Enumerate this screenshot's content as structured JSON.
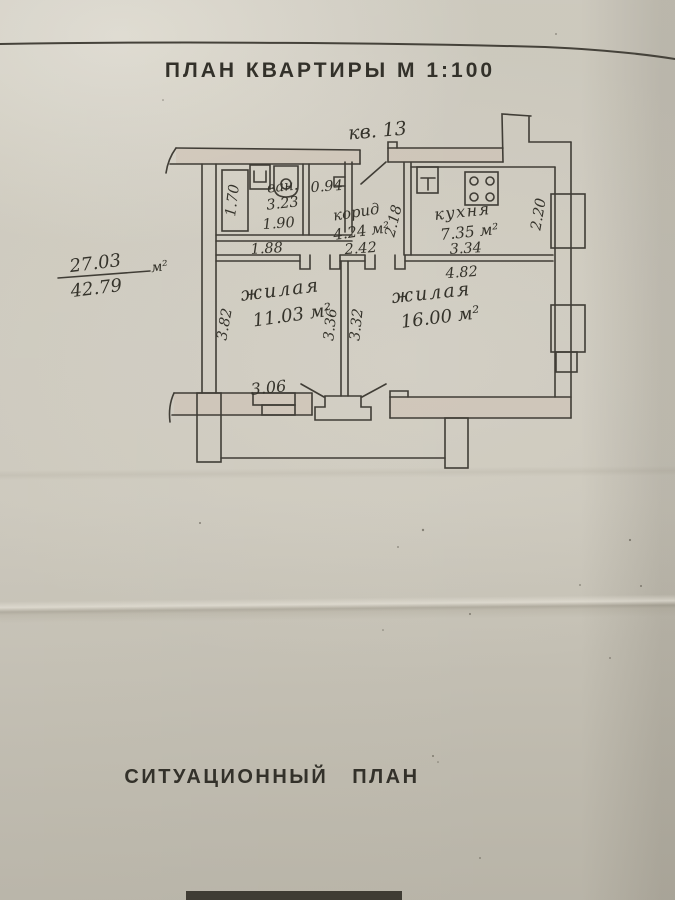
{
  "document": {
    "title": "ПЛАН КВАРТИРЫ М 1:100",
    "section_title": "СИТУАЦИОННЫЙ ПЛАН",
    "apartment_label": "кв. 13"
  },
  "area_summary": {
    "living_area": "27.03",
    "total_area": "42.79",
    "unit": "м²"
  },
  "rooms": {
    "bathroom": {
      "name": "ван.",
      "area": "3.23",
      "dim_width": "1.90",
      "dim_tub": "1.70",
      "dim_below": "1.88"
    },
    "wc": {
      "area": "0.94"
    },
    "corridor": {
      "name": "корид",
      "area": "4.24 м²",
      "dim_width": "2.42",
      "dim_depth": "2.18"
    },
    "kitchen": {
      "name": "кухня",
      "area": "7.35 м²",
      "dim_width": "3.34",
      "dim_depth": "2.20"
    },
    "living_room_1": {
      "name": "жилая",
      "area": "11.03 м²",
      "dim_left": "3.82",
      "dim_right": "3.36",
      "dim_bottom": "3.06"
    },
    "living_room_2": {
      "name": "жилая",
      "area": "16.00 м²",
      "dim_left": "3.32",
      "dim_top": "4.82"
    }
  }
}
